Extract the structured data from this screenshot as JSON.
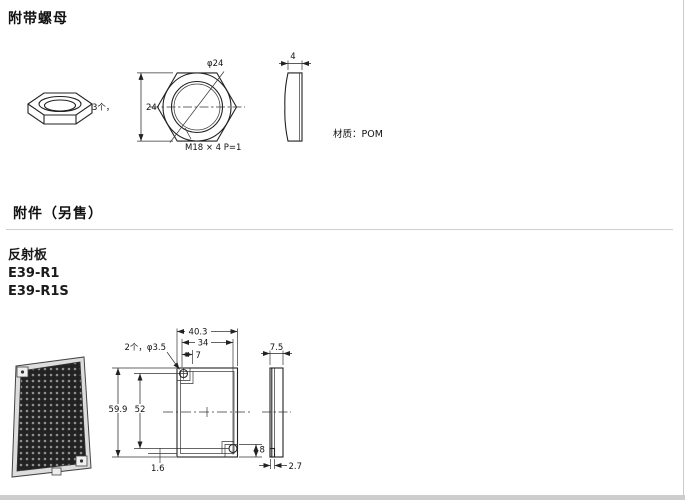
{
  "headings": {
    "section1": "附带螺母",
    "section2": "附件（另售）"
  },
  "reflector": {
    "label": "反射板",
    "model1": "E39-R1",
    "model2": "E39-R1S"
  },
  "nut_drawing": {
    "phi": "φ24",
    "qty": "3个，",
    "height": "24",
    "thread": "M18 × 4  P=1",
    "thickness": "4",
    "material": "材质：POM"
  },
  "reflector_drawing": {
    "width": "40.3",
    "hole_span": "34",
    "offset7": "7",
    "holes": "2个，φ3.5",
    "height": "59.9",
    "hole_height": "52",
    "one_six": "1.6",
    "eight": "8",
    "side_width": "7.5",
    "two_seven": "2.7"
  }
}
